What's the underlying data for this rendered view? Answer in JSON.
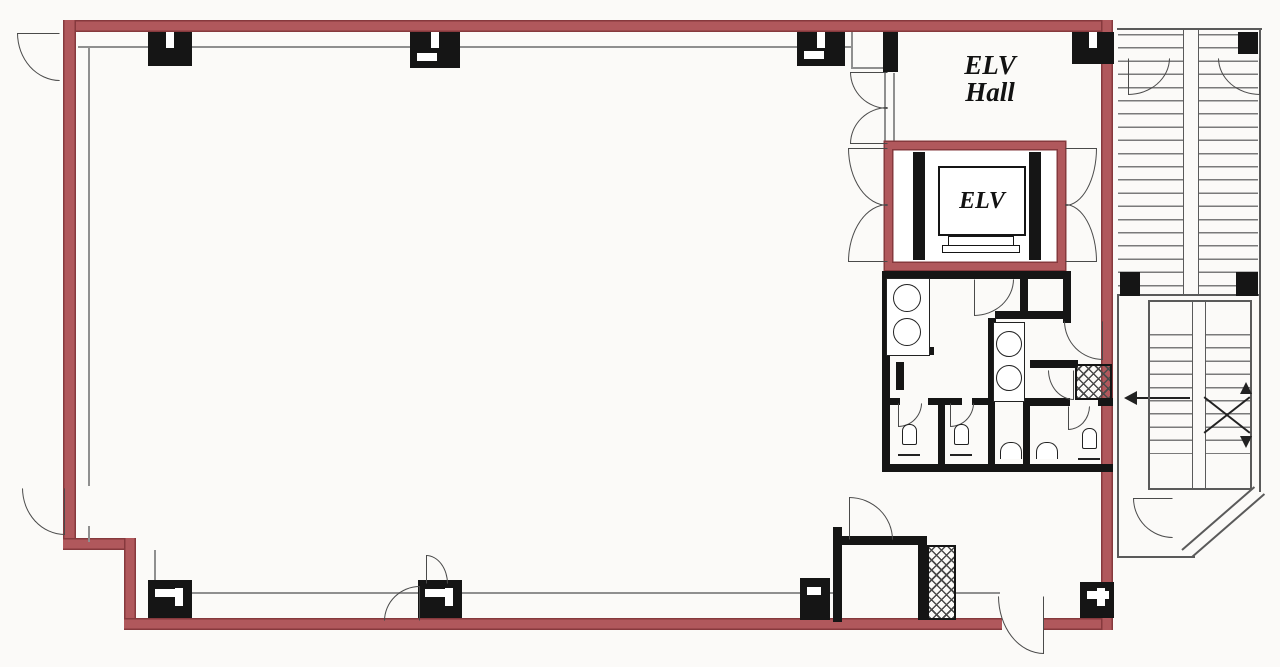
{
  "page": {
    "background": "#fbfaf8",
    "description": "architectural floor plan, office floor with elevator hall, restrooms and staircase"
  },
  "plan": {
    "labels": {
      "hall_line1": "ELV",
      "hall_line2": "Hall",
      "elevator_cab": "ELV"
    },
    "colors": {
      "wall_red": "#b0585c",
      "wall_red_edge": "#86393d",
      "window_line": "#8f8f8f",
      "wall_black": "#151515",
      "door_line": "#4a4a4a",
      "stair_line": "#5a5a5a",
      "tread_line": "#7a7a7a",
      "fixture_line": "#222222",
      "text": "#121212"
    }
  }
}
